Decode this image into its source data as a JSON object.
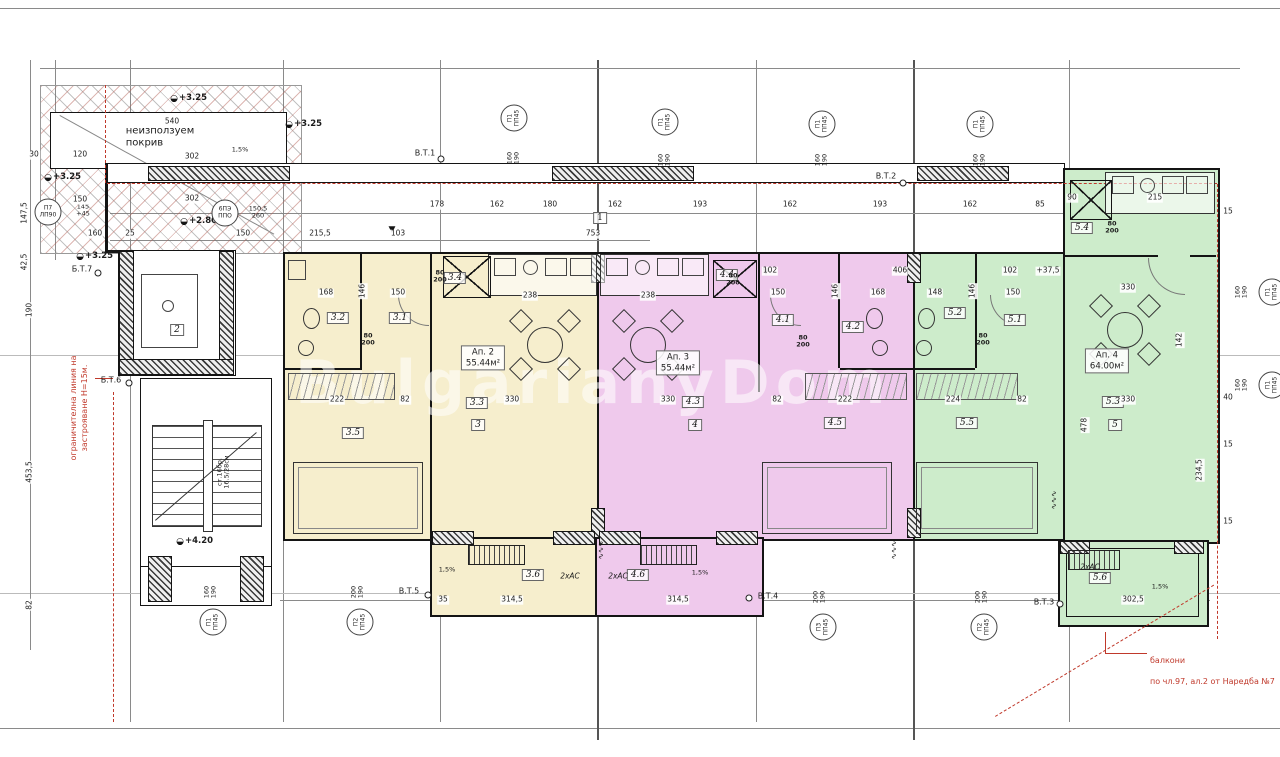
{
  "colors": {
    "apartment2_fill": "#f6eecd",
    "apartment3_fill": "#efc9ec",
    "apartment4_fill": "#cdeccb",
    "wall_black": "#141414",
    "annotation_red": "#c0392b"
  },
  "watermark": "BulgarianyDom",
  "roof": {
    "label": "неизползуем\nпокрив"
  },
  "grid": {
    "axis_1": "1"
  },
  "icons": {
    "benchmark": "◒",
    "entrance": "▼",
    "radiator": "∿∿∿"
  },
  "core": {
    "elevator_room": "2",
    "stairs_note": "ст.16бр.\n16.5/28см",
    "elev_420": "+4.20"
  },
  "elevations": {
    "e325": "+3.25",
    "e280": "+2.80"
  },
  "markers": {
    "vt1": "В.Т.1",
    "vt2": "В.Т.2",
    "vt3": "В.Т.3",
    "vt4": "В.Т.4",
    "vt5": "В.Т.5",
    "bt6": "Б.Т.6",
    "bt7": "Б.Т.7"
  },
  "ducts": {
    "p1": "П1\nПП45",
    "p2": "П2\nПП45",
    "p3": "П3\nПП45",
    "p7": "П7\nЛП90",
    "bpe": "6ПЭ\nППО",
    "dim_160_190": "160\n190",
    "dim_200_190": "200\n190",
    "dim_145": "145\n+45",
    "dim_150": "150,5\n260"
  },
  "misc": {
    "shaft": "80\n200",
    "ac": "2хАС",
    "slope": "1,5%"
  },
  "notes": {
    "balcony_line1": "балкони",
    "balcony_line2": "по чл.97, ал.2 от Наредба №7",
    "limit": "ограничителна линия на\nзастрояване Н=15м."
  },
  "apartments": {
    "ap2": {
      "name": "Ап. 2",
      "area": "55.44м²",
      "rooms": {
        "r1": "3.1",
        "r2": "3.2",
        "r3": "3.3",
        "r4": "3.4",
        "r5": "3.5",
        "r6": "3.6",
        "main": "3"
      }
    },
    "ap3": {
      "name": "Ап. 3",
      "area": "55.44м²",
      "rooms": {
        "r1": "4.1",
        "r2": "4.2",
        "r3": "4.3",
        "r4": "4.4",
        "r5": "4.5",
        "r6": "4.6",
        "main": "4"
      }
    },
    "ap4": {
      "name": "Ап. 4",
      "area": "64.00м²",
      "rooms": {
        "r1": "5.1",
        "r2": "5.2",
        "r3": "5.3",
        "r4": "5.4",
        "r5": "5.5",
        "r6": "5.6",
        "main": "5"
      }
    }
  },
  "dims": {
    "topA": [
      "178",
      "162",
      "180",
      "162",
      "193",
      "162",
      "193",
      "162",
      "85"
    ],
    "topB": [
      "103",
      "753",
      "102",
      "406",
      "102",
      "+37,5"
    ],
    "roof": [
      "540",
      "302",
      "120",
      "30",
      "302",
      "150",
      "160",
      "25",
      "150",
      "215,5"
    ],
    "left": [
      "147,5",
      "42,5",
      "190",
      "453,5",
      "82"
    ],
    "right": [
      "15",
      "40",
      "15",
      "15",
      "234,5"
    ],
    "bottom": [
      "35",
      "314,5",
      "314,5",
      "302,5"
    ],
    "innerYellow": [
      "168",
      "146",
      "150",
      "238",
      "222",
      "82",
      "330"
    ],
    "innerPurple": [
      "238",
      "150",
      "146",
      "168",
      "330",
      "222",
      "82"
    ],
    "innerGreen": [
      "148",
      "146",
      "150",
      "330",
      "224",
      "82",
      "330",
      "142",
      "478",
      "90",
      "215"
    ]
  }
}
